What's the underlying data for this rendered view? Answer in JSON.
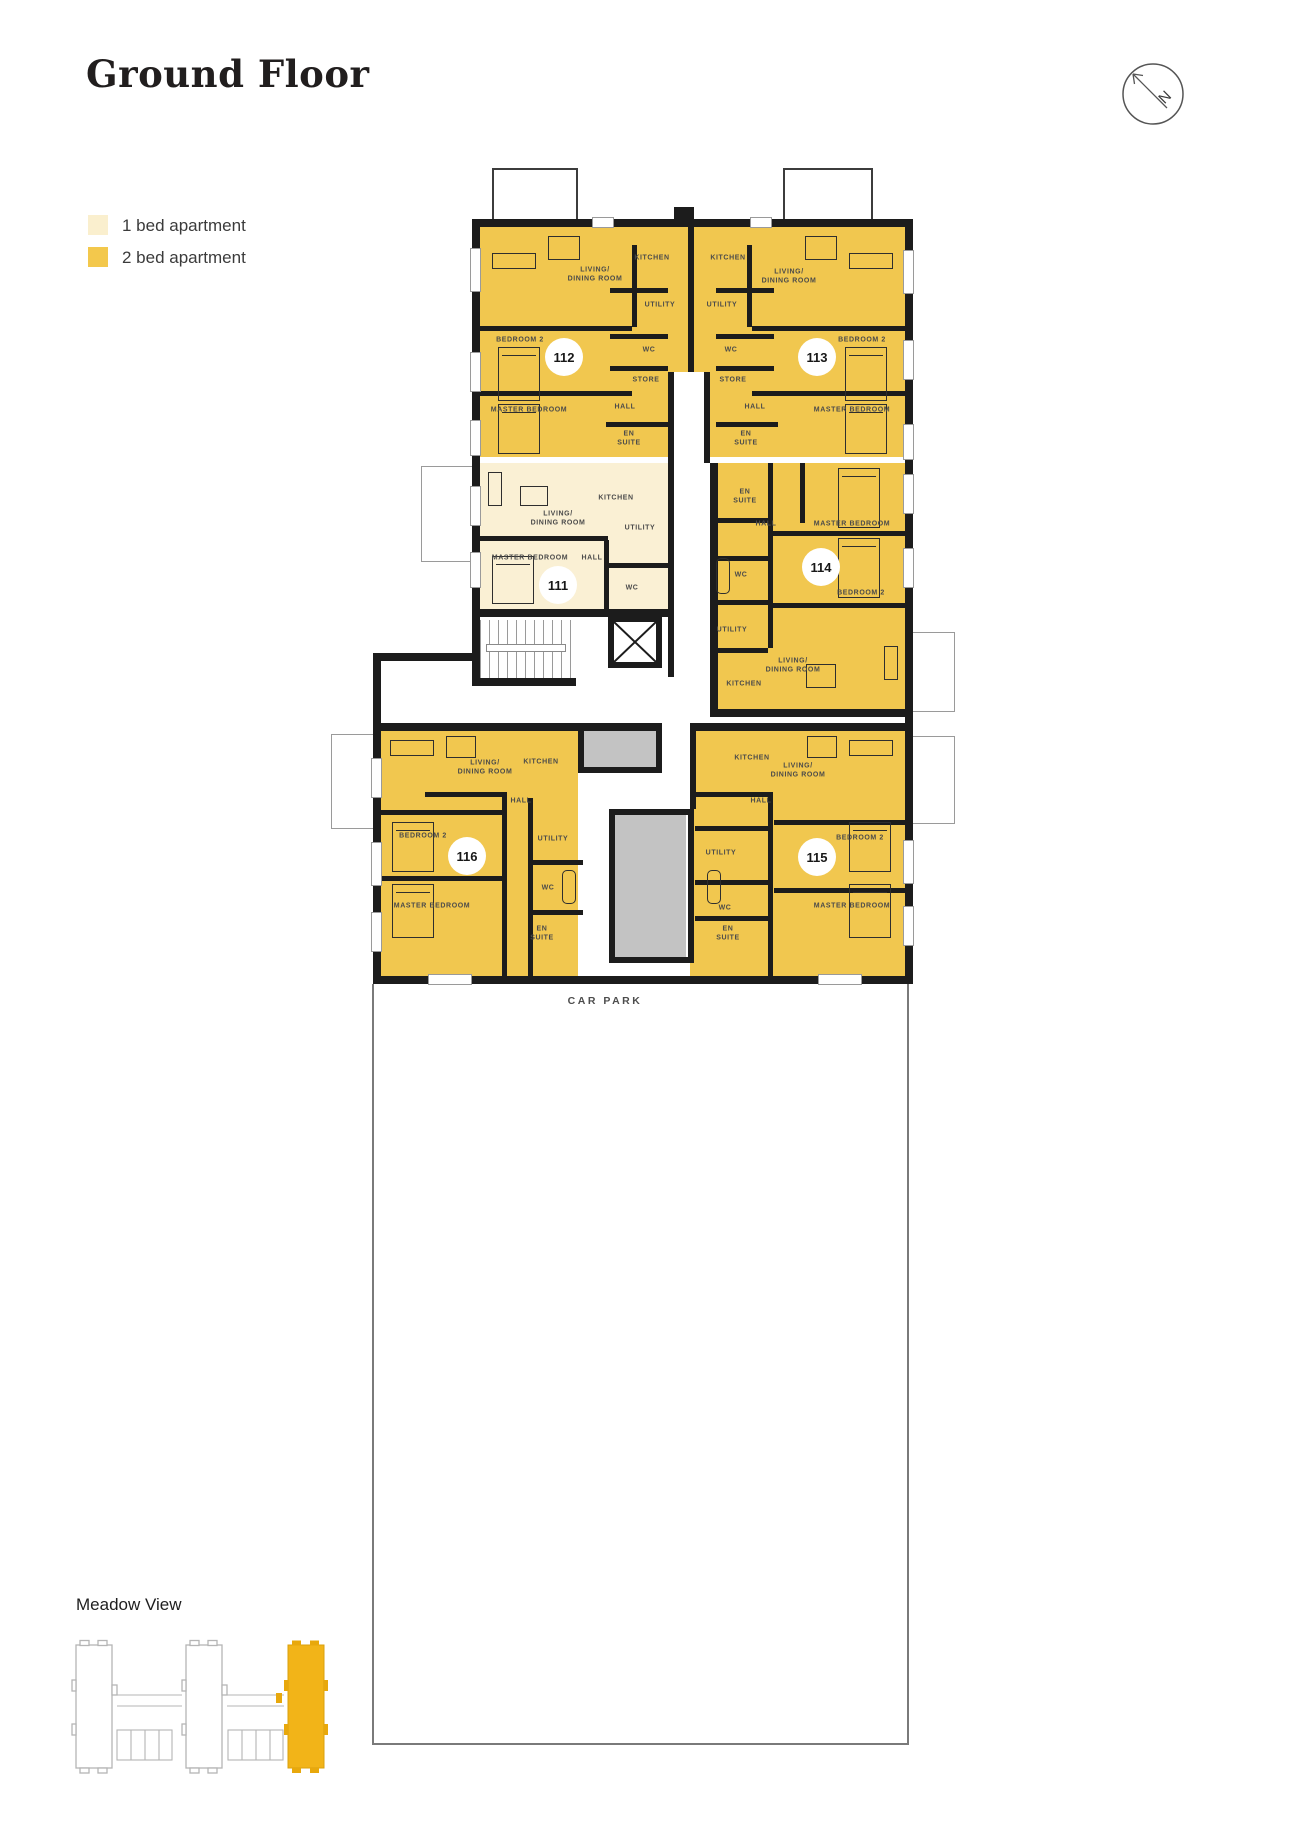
{
  "title": "Ground Floor",
  "compass": {
    "label": "N"
  },
  "legend": {
    "items": [
      {
        "label": "1 bed apartment",
        "color": "#FAEFCE"
      },
      {
        "label": "2 bed apartment",
        "color": "#F3C84C"
      }
    ]
  },
  "colors": {
    "two_bed_fill": "#F1C74F",
    "one_bed_fill": "#FAF0D4",
    "walls": "#1C1C1C",
    "communal_gray": "#C3C3C3",
    "siteplan_highlight": "#F2B418"
  },
  "rooms": {
    "living": "LIVING/\nDINING ROOM",
    "kitchen": "KITCHEN",
    "utility": "UTILITY",
    "wc": "WC",
    "store": "STORE",
    "hall": "HALL",
    "en_suite": "EN\nSUITE",
    "master": "MASTER BEDROOM",
    "bedroom2": "BEDROOM 2"
  },
  "units": {
    "u111": {
      "number": "111",
      "type": "1 bed apartment"
    },
    "u112": {
      "number": "112",
      "type": "2 bed apartment"
    },
    "u113": {
      "number": "113",
      "type": "2 bed apartment"
    },
    "u114": {
      "number": "114",
      "type": "2 bed apartment"
    },
    "u115": {
      "number": "115",
      "type": "2 bed apartment"
    },
    "u116": {
      "number": "116",
      "type": "2 bed apartment"
    }
  },
  "car_park": {
    "label": "CAR PARK"
  },
  "site_plan": {
    "title": "Meadow View"
  }
}
